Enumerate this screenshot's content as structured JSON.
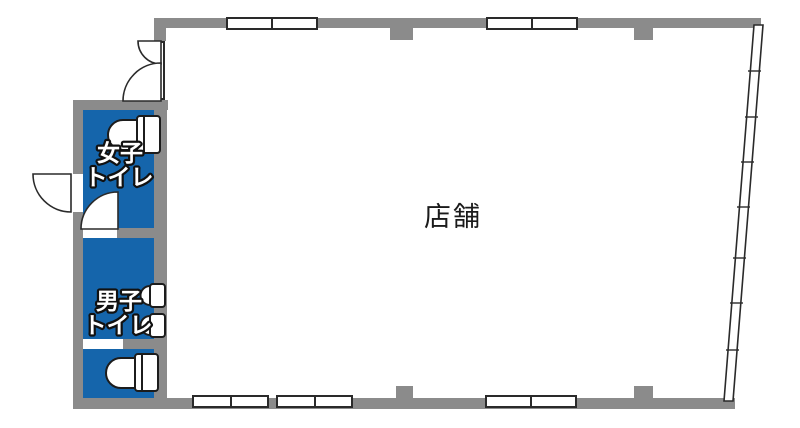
{
  "plan": {
    "store": {
      "label": "店舗"
    },
    "womens_toilet": {
      "line1": "女子",
      "line2": "トイレ"
    },
    "mens_toilet": {
      "line1": "男子",
      "line2": "トイレ"
    },
    "colors": {
      "toilet_area_blue": "#1565ab",
      "wall_gray": "#8b8b8b",
      "outline_black": "#2a2a2a",
      "background_white": "#ffffff"
    },
    "icons": {
      "toilet": "toilet-icon",
      "urinal": "urinal-icon",
      "door_swing": "door-swing-arc-icon",
      "window": "sliding-window-icon",
      "window_band": "slanted-window-band-icon"
    }
  }
}
